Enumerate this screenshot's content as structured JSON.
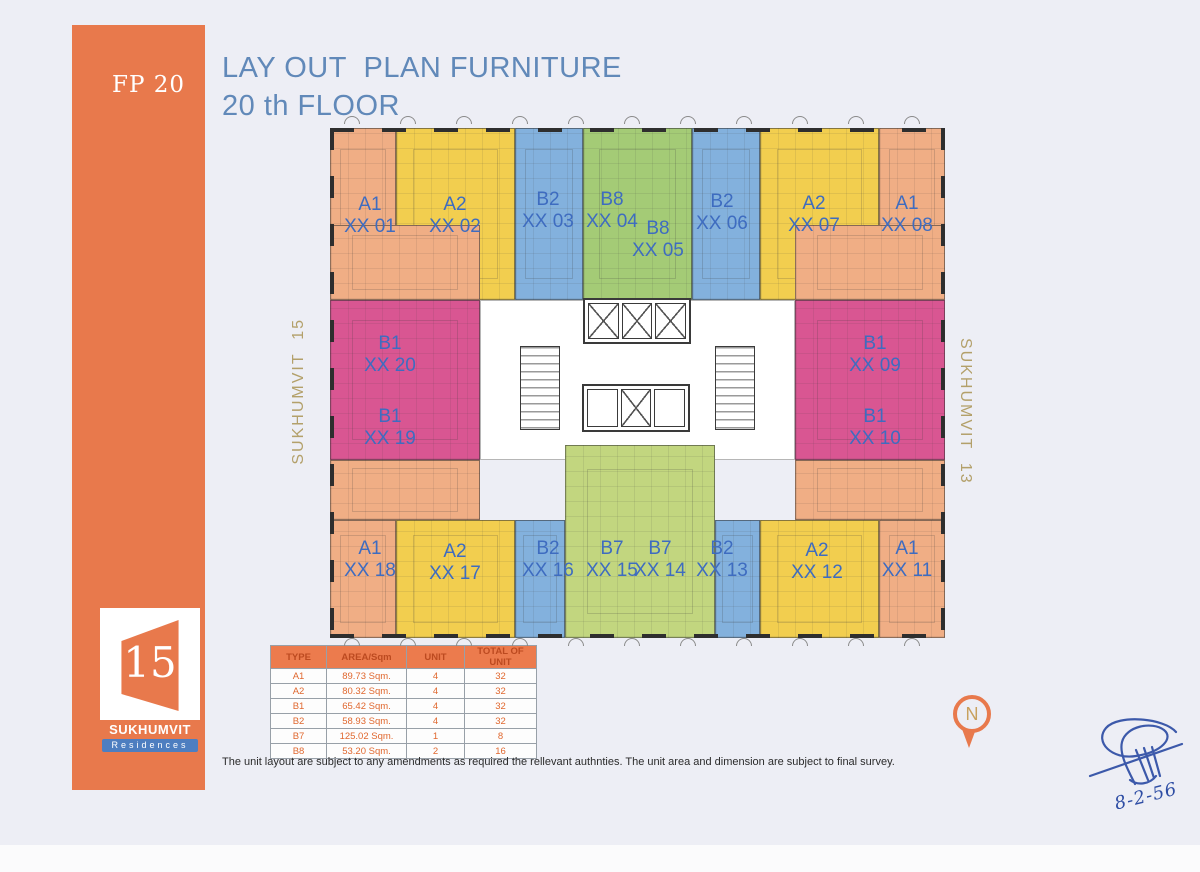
{
  "page": {
    "sheet_code": "FP 20",
    "title_line1": "LAY OUT  PLAN FURNITURE",
    "title_line2": "20 th FLOOR",
    "disclaimer": "The unit layout are subject to any amendments as required the rellevant authnties. The unit area and dimension are subject to final survey.",
    "handwritten_date": "8-2-56"
  },
  "logo": {
    "number": "15",
    "name": "SUKHUMVIT",
    "subtitle": "Residences"
  },
  "streets": {
    "left": "SUKHUMVIT  15",
    "right": "SUKHUMVIT  13"
  },
  "north_label": "N",
  "colors": {
    "accent_orange": "#e8794c",
    "label_blue": "#3e6cc0",
    "title_blue": "#6189b9",
    "street_tan": "#b3a06a",
    "signature_ink": "#2e4da4",
    "unit_peach": "#f0ae85",
    "unit_yellow": "#f2ce4f",
    "unit_blue": "#83b1dd",
    "unit_green": "#a4cb76",
    "unit_greenlight": "#c2d67f",
    "unit_magenta": "#d95692",
    "unit_white": "#ffffff"
  },
  "floorplan": {
    "blocks": [
      {
        "c": "peach",
        "x": 0,
        "y": 0,
        "w": 66,
        "h": 172
      },
      {
        "c": "yellow",
        "x": 66,
        "y": 0,
        "w": 119,
        "h": 172
      },
      {
        "c": "blue",
        "x": 185,
        "y": 0,
        "w": 68,
        "h": 172
      },
      {
        "c": "green",
        "x": 253,
        "y": 0,
        "w": 109,
        "h": 172
      },
      {
        "c": "blue",
        "x": 362,
        "y": 0,
        "w": 68,
        "h": 172
      },
      {
        "c": "yellow",
        "x": 430,
        "y": 0,
        "w": 119,
        "h": 172
      },
      {
        "c": "peach",
        "x": 549,
        "y": 0,
        "w": 66,
        "h": 172
      },
      {
        "c": "peach",
        "x": 0,
        "y": 97,
        "w": 150,
        "h": 75
      },
      {
        "c": "peach",
        "x": 465,
        "y": 97,
        "w": 150,
        "h": 75
      },
      {
        "c": "magenta",
        "x": 0,
        "y": 172,
        "w": 150,
        "h": 160
      },
      {
        "c": "magenta",
        "x": 465,
        "y": 172,
        "w": 150,
        "h": 160
      },
      {
        "c": "white",
        "x": 150,
        "y": 172,
        "w": 315,
        "h": 160
      },
      {
        "c": "peach",
        "x": 0,
        "y": 332,
        "w": 150,
        "h": 60
      },
      {
        "c": "peach",
        "x": 465,
        "y": 332,
        "w": 150,
        "h": 60
      },
      {
        "c": "greenlight",
        "x": 235,
        "y": 317,
        "w": 150,
        "h": 193
      },
      {
        "c": "peach",
        "x": 0,
        "y": 392,
        "w": 66,
        "h": 118
      },
      {
        "c": "yellow",
        "x": 66,
        "y": 392,
        "w": 119,
        "h": 118
      },
      {
        "c": "blue",
        "x": 185,
        "y": 392,
        "w": 50,
        "h": 118
      },
      {
        "c": "blue",
        "x": 385,
        "y": 392,
        "w": 45,
        "h": 118
      },
      {
        "c": "yellow",
        "x": 430,
        "y": 392,
        "w": 119,
        "h": 118
      },
      {
        "c": "peach",
        "x": 549,
        "y": 392,
        "w": 66,
        "h": 118
      }
    ],
    "units": [
      {
        "t": "A1",
        "n": "XX 01",
        "x": 40,
        "y": 88
      },
      {
        "t": "A2",
        "n": "XX 02",
        "x": 125,
        "y": 88
      },
      {
        "t": "B2",
        "n": "XX 03",
        "x": 218,
        "y": 83
      },
      {
        "t": "B8",
        "n": "XX 04",
        "x": 282,
        "y": 83
      },
      {
        "t": "B8",
        "n": "XX 05",
        "x": 328,
        "y": 112
      },
      {
        "t": "B2",
        "n": "XX 06",
        "x": 392,
        "y": 85
      },
      {
        "t": "A2",
        "n": "XX 07",
        "x": 484,
        "y": 87
      },
      {
        "t": "A1",
        "n": "XX 08",
        "x": 577,
        "y": 87
      },
      {
        "t": "B1",
        "n": "XX 20",
        "x": 60,
        "y": 227
      },
      {
        "t": "B1",
        "n": "XX 19",
        "x": 60,
        "y": 300
      },
      {
        "t": "B1",
        "n": "XX 09",
        "x": 545,
        "y": 227
      },
      {
        "t": "B1",
        "n": "XX 10",
        "x": 545,
        "y": 300
      },
      {
        "t": "A1",
        "n": "XX 18",
        "x": 40,
        "y": 432
      },
      {
        "t": "A2",
        "n": "XX 17",
        "x": 125,
        "y": 435
      },
      {
        "t": "B2",
        "n": "XX 16",
        "x": 218,
        "y": 432
      },
      {
        "t": "B7",
        "n": "XX 15",
        "x": 282,
        "y": 432
      },
      {
        "t": "B7",
        "n": "XX 14",
        "x": 330,
        "y": 432
      },
      {
        "t": "B2",
        "n": "XX 13",
        "x": 392,
        "y": 432
      },
      {
        "t": "A2",
        "n": "XX 12",
        "x": 487,
        "y": 434
      },
      {
        "t": "A1",
        "n": "XX 11",
        "x": 577,
        "y": 432
      }
    ]
  },
  "table": {
    "headers": [
      "TYPE",
      "AREA/Sqm",
      "UNIT",
      "TOTAL OF UNIT"
    ],
    "rows": [
      [
        "A1",
        "89.73 Sqm.",
        "4",
        "32"
      ],
      [
        "A2",
        "80.32 Sqm.",
        "4",
        "32"
      ],
      [
        "B1",
        "65.42 Sqm.",
        "4",
        "32"
      ],
      [
        "B2",
        "58.93 Sqm.",
        "4",
        "32"
      ],
      [
        "B7",
        "125.02 Sqm.",
        "1",
        "8"
      ],
      [
        "B8",
        "53.20 Sqm.",
        "2",
        "16"
      ]
    ]
  }
}
